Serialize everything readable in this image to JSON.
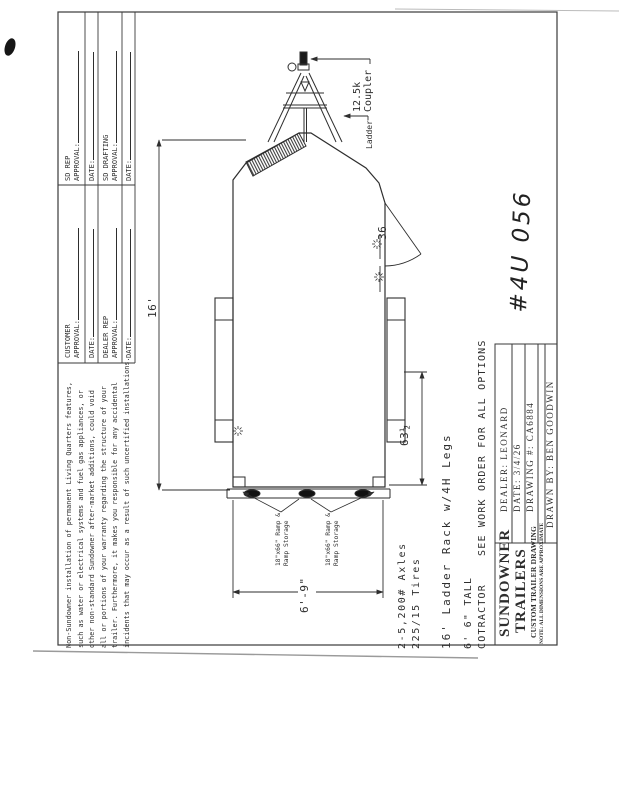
{
  "sheet": {
    "handwritten_number": "#4U 056",
    "approvals": {
      "sd_rep_line1": "SD REP",
      "sd_rep_line2": "APPROVAL:",
      "date_label": "DATE:",
      "sd_drafting_line1": "SD DRAFTING",
      "sd_drafting_line2": "APPROVAL:",
      "customer_line1": "CUSTOMER",
      "customer_line2": "APPROVAL:",
      "dealer_rep_line1": "DEALER REP",
      "dealer_rep_line2": "APPROVAL:"
    },
    "disclaimer": {
      "lines": [
        "Non-Sundowner installation of permanent Living Quarters features,",
        "such as water or electrical systems and fuel gas appliances, or",
        "other non-standard Sundowner after-market additions, could void",
        "all or portions of your warranty regarding the structure of your",
        "trailer. Furthermore, it makes you responsible for any accidental",
        "incidents that may occur as a result of such uncertified installations."
      ]
    }
  },
  "drawing": {
    "coupler_label_line1": "12.5k",
    "coupler_label_line2": "Coupler",
    "ladder_label": "Ladder",
    "door_width_label": "36",
    "length_dim": "16'",
    "rear_dim": "63½",
    "width_dim": "6'-9\"",
    "ramp_left_line1": "18\"x66\" Ramp &",
    "ramp_left_line2": "Ramp Storage",
    "ramp_right_line1": "18\"x66\" Ramp &",
    "ramp_right_line2": "Ramp Storage"
  },
  "options": {
    "axles": "2-5,200# Axles",
    "tires": "225/15 Tires",
    "ladder_rack": "16' Ladder Rack w/4H Legs",
    "height": "6' 6\" TALL",
    "contractor": "COTRACTOR",
    "work_order_note": "SEE WORK ORDER FOR ALL OPTIONS"
  },
  "title_block": {
    "company_line1": "SUNDOWNER",
    "company_line2": "TRAILERS",
    "subtitle": "CUSTOM TRAILER DRAWING",
    "note": "NOTE: ALL DIMENSIONS ARE APPROXIMATE",
    "dealer": "DEALER: LEONARD",
    "date": "DATE: 3/4/26",
    "drawing_number": "DRAWING #: CA6884",
    "drawn_by": "DRAWN BY: BEN GOODWIN"
  },
  "colors": {
    "ink": "#2e2e2e",
    "paper": "#ffffff"
  }
}
